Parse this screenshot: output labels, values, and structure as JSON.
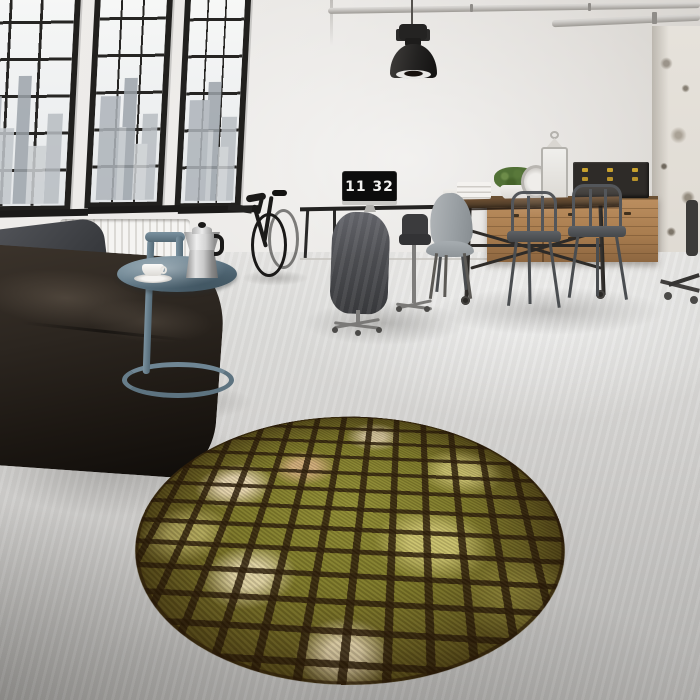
{
  "scene": {
    "kind": "interior-photograph",
    "setting": "industrial loft living room with concrete floor, black steel factory windows and a round mosaic rug",
    "monitor_clock": {
      "time": "11 32",
      "hours": "11",
      "minutes": "32"
    },
    "objects": [
      "factory-windows-with-city-skyline",
      "ceiling-pipes",
      "industrial-pendant-lamp",
      "dark-leather-sofa",
      "grey-cushion",
      "white-radiator",
      "steel-blue-side-table",
      "moka-coffee-pot",
      "white-cup-and-saucer",
      "black-bicycle",
      "work-desk",
      "monitor-flip-clock",
      "office-chair-with-grey-coat",
      "grey-molded-chair",
      "industrial-dining-table-on-casters",
      "metal-tolix-armchairs",
      "wooden-sideboard",
      "black-storage-boxes-with-brass-latches",
      "potted-plant",
      "white-lanterns",
      "distressed-plaster-column",
      "round-yellow-mosaic-rug"
    ],
    "palette": {
      "wall": "#e7e5e2",
      "floor_light": "#e6e5e3",
      "floor_dark": "#aeadab",
      "window_frame": "#21201e",
      "leather": "#2a241e",
      "steel_blue": "#5d7380",
      "wood": "#a97d4f",
      "rug_olive": "#7d7929",
      "rug_grout": "#2b1c0a",
      "rug_cream": "#eedcb9",
      "brass": "#c9a22e"
    }
  }
}
